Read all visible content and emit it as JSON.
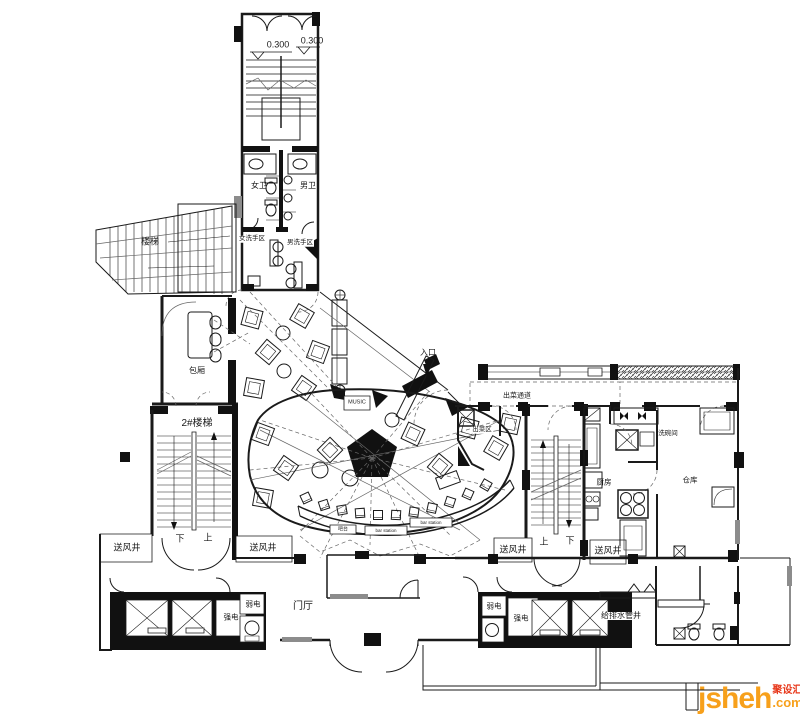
{
  "plan": {
    "labels": [
      {
        "id": "elev-mark-left",
        "text": "0.300"
      },
      {
        "id": "elev-mark-right",
        "text": "0.300"
      },
      {
        "id": "womens-wc",
        "text": "女卫"
      },
      {
        "id": "mens-wc",
        "text": "男卫"
      },
      {
        "id": "womens-wash",
        "text": "女洗手区"
      },
      {
        "id": "mens-wash",
        "text": "男洗手区"
      },
      {
        "id": "stairs-left",
        "text": "楼梯"
      },
      {
        "id": "private-room",
        "text": "包厢"
      },
      {
        "id": "stair-2",
        "text": "2#楼梯"
      },
      {
        "id": "stair2-down",
        "text": "下"
      },
      {
        "id": "stair2-up",
        "text": "上"
      },
      {
        "id": "air-shaft-1",
        "text": "送风井"
      },
      {
        "id": "air-shaft-2",
        "text": "送风井"
      },
      {
        "id": "entrance",
        "text": "入口"
      },
      {
        "id": "music-zone",
        "text": "MUSIC"
      },
      {
        "id": "food-pass",
        "text": "出菜通道"
      },
      {
        "id": "food-area",
        "text": "出菜区"
      },
      {
        "id": "dishwash-room",
        "text": "洗碗间"
      },
      {
        "id": "kitchen",
        "text": "厨房"
      },
      {
        "id": "storage",
        "text": "仓库"
      },
      {
        "id": "stair-mid-up",
        "text": "上"
      },
      {
        "id": "stair-mid-down",
        "text": "下"
      },
      {
        "id": "air-shaft-3",
        "text": "送风井"
      },
      {
        "id": "air-shaft-4",
        "text": "送风井"
      },
      {
        "id": "lobby",
        "text": "门厅"
      },
      {
        "id": "strong-elec-left",
        "text": "强电"
      },
      {
        "id": "weak-elec-left",
        "text": "弱电"
      },
      {
        "id": "weak-elec-right",
        "text": "弱电"
      },
      {
        "id": "strong-elec-right",
        "text": "强电"
      },
      {
        "id": "plumbing-shaft",
        "text": "给排水管井"
      },
      {
        "id": "bar-counter",
        "text": "吧台"
      },
      {
        "id": "bar-station-1",
        "text": "bar station"
      },
      {
        "id": "bar-station-2",
        "text": "bar station"
      }
    ]
  },
  "watermark": {
    "brand": "jsheh",
    "brand_cn": "聚设汇",
    "suffix": ".com",
    "color_orange": "#F7A01B",
    "color_red": "#E8391C"
  }
}
